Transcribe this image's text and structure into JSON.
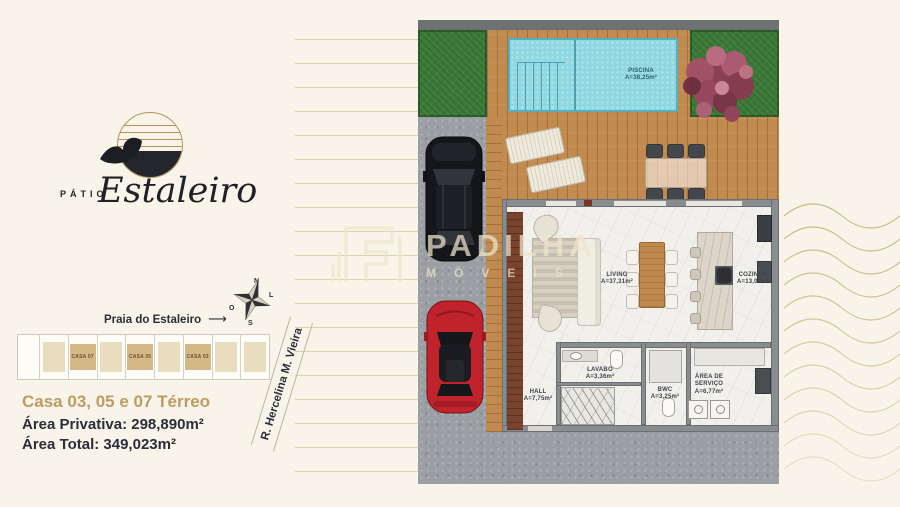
{
  "brand": {
    "patio": "PÁTIO",
    "estaleiro": "Estaleiro"
  },
  "compass": {
    "n": "N",
    "e": "L",
    "w": "O",
    "s": "S"
  },
  "left_panel": {
    "beach_label": "Praia do Estaleiro",
    "arrow": "⟶",
    "street_label": "R. Hercelina M. Vieira",
    "title": "Casa 03, 05 e 07 Térreo",
    "area_private": "Área Privativa: 298,890m²",
    "area_total": "Área Total: 349,023m²",
    "lots": [
      {
        "label": ""
      },
      {
        "label": "CASA 07"
      },
      {
        "label": ""
      },
      {
        "label": "CASA 05"
      },
      {
        "label": ""
      },
      {
        "label": "CASA 03"
      },
      {
        "label": ""
      },
      {
        "label": ""
      }
    ]
  },
  "plan": {
    "piscina": {
      "name": "PISCINA",
      "area": "A=38,25m²"
    },
    "living": {
      "name": "LIVING",
      "area": "A=37,31m²"
    },
    "cozinha": {
      "name": "COZINHA",
      "area": "A=13,07m²"
    },
    "hall": {
      "name": "HALL",
      "area": "A=7,75m²"
    },
    "lavabo": {
      "name": "LAVABO",
      "area": "A=3,36m²"
    },
    "bwc": {
      "name": "BWC",
      "area": "A=3,25m²"
    },
    "servico": {
      "name": "ÁREA DE SERVIÇO",
      "area": "A=6,77m²"
    }
  },
  "watermark": {
    "name": "PADILHA",
    "sub": "MÓVEIS"
  },
  "colors": {
    "bg": "#f8f4e9",
    "gold": "#b4945a",
    "gold_text": "#bb9c63",
    "stripe": "#dcd2ab",
    "ink": "#2b2e3a",
    "wall": "#8a8d90",
    "wall_dark": "#6d7174",
    "grass": "#3d7b39",
    "deck": "#c18a4e",
    "pool": "#8fd8e1",
    "drive": "#9b9ea2",
    "floor": "#f1f0ec",
    "mahogany": "#7a432d",
    "marble": "#dbd5ca",
    "wood_table": "#bf8a4e",
    "red_car": "#c0232b",
    "label": "#3e4147",
    "tan_dark": "#d3b888",
    "tan_light": "#e9ddbf",
    "wave": "#c8b47c",
    "watermark": "#f0e5cd"
  }
}
